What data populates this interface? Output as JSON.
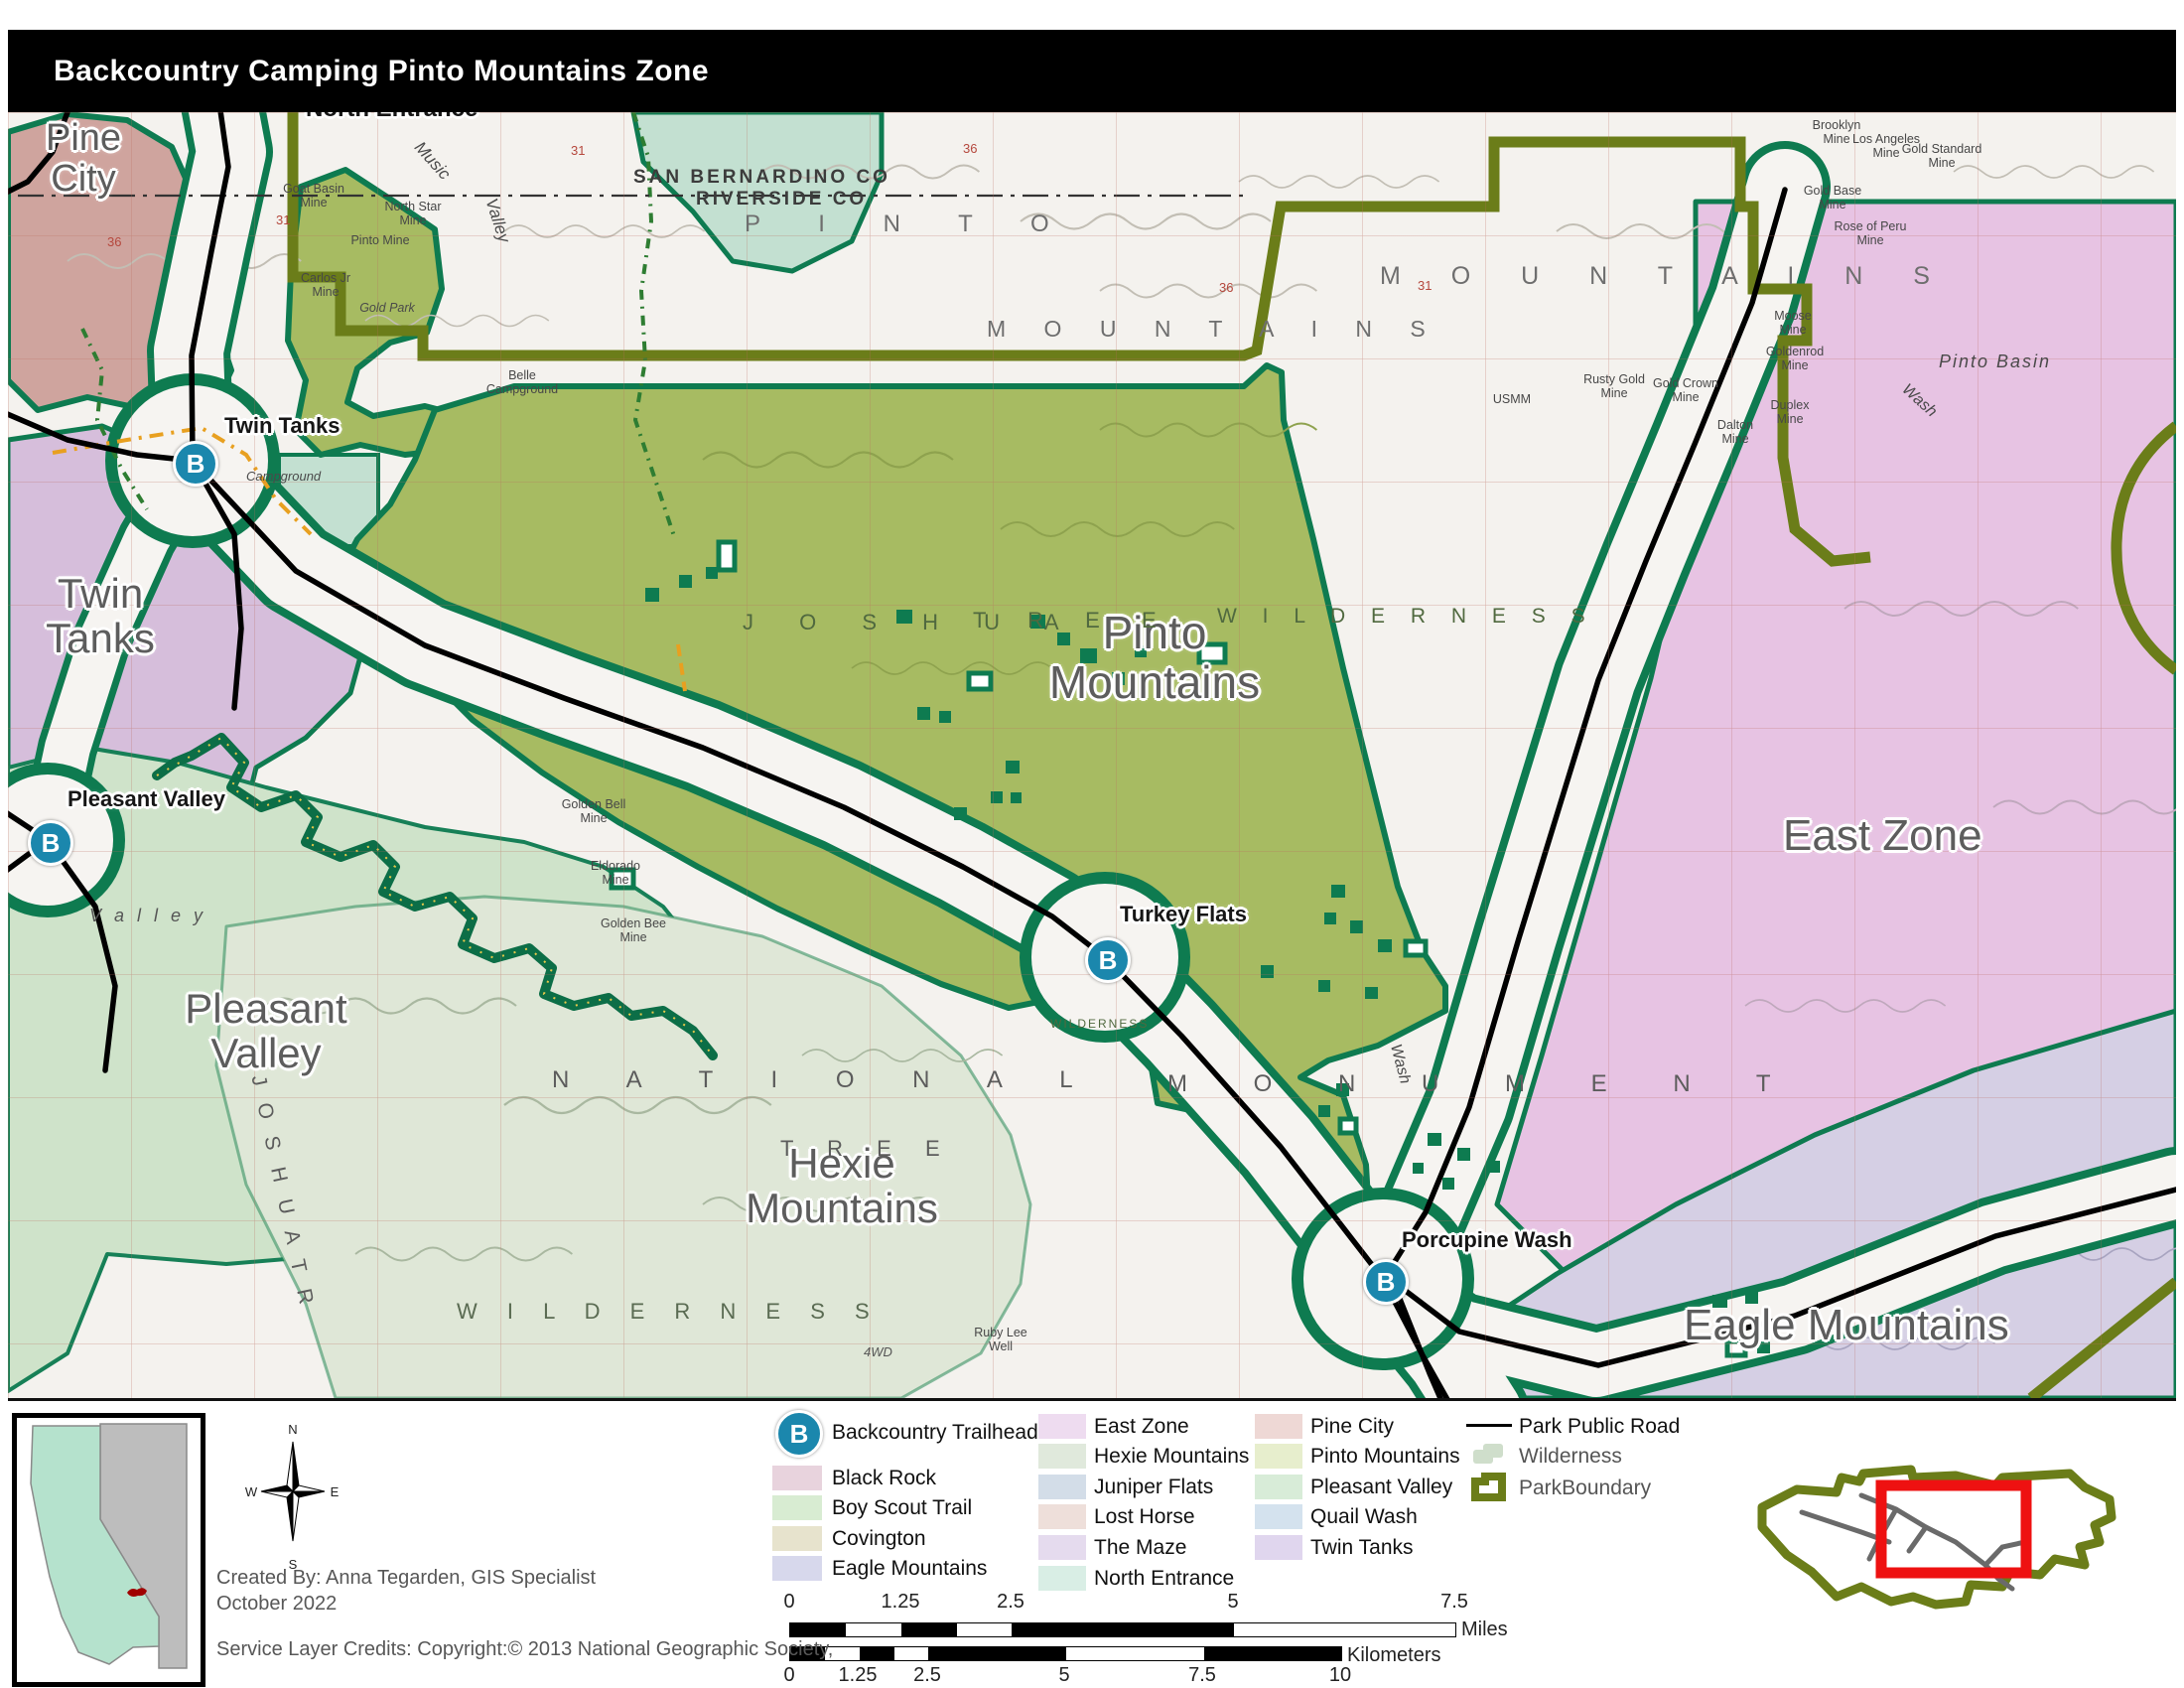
{
  "title": "Backcountry Camping Pinto Mountains Zone",
  "map": {
    "zone_labels": {
      "pine_city": "Pine\nCity",
      "twin_tanks": "Twin\nTanks",
      "pleasant_valley": "Pleasant\nValley",
      "hexie": "Hexie\nMountains",
      "pinto": "Pinto\nMountains",
      "east_zone": "East Zone",
      "eagle": "Eagle Mountains"
    },
    "trailheads": {
      "symbol": "B",
      "north_entrance": "North Entrance",
      "twin_tanks": "Twin Tanks",
      "pleasant_valley": "Pleasant Valley",
      "turkey_flats": "Turkey Flats",
      "porcupine_wash": "Porcupine Wash"
    },
    "topo": {
      "county1": "SAN BERNARDINO  CO",
      "county2": "RIVERSIDE  CO",
      "pinto_sp": "P I N T O",
      "mountains_sp": "M O U N T A I N S",
      "mountains_sp2": "M O U N T A I N S",
      "joshua_sp": "J O S H U A",
      "tree_sp": "T R E E",
      "wilderness_sp": "W I L D E R N E S S",
      "national_sp": "N A T I O N A L",
      "monument_sp": "M O N U M E N T",
      "tree_sp2": "T R E E",
      "joshua_rot": "J O S H U A   T R",
      "wilderness_sp2": "W I L D E R N E S S",
      "wilderness_tiny": "WILDERNESS",
      "valley_pv": "V a l l e y",
      "music": "Music",
      "valley": "Valley",
      "pinto_basin": "Pinto    Basin",
      "wash": "Wash",
      "wash2": "Wash",
      "fourwd": "4WD",
      "usmm": "USMM",
      "campground": "Campground"
    },
    "mines": {
      "goat": "Goat Basin\nMine",
      "north_star": "North Star\nMine",
      "pinto_mine": "Pinto Mine",
      "carlos": "Carlos Jr\nMine",
      "gold_park": "Gold Park",
      "belle": "Belle\nCampground",
      "brooklyn": "Brooklyn\nMine",
      "los_angeles": "Los Angeles\nMine",
      "gold_standard": "Gold Standard\nMine",
      "gold_base": "Gold Base\nMine",
      "rose_peru": "Rose of Peru\nMine",
      "moose": "Moose\nMine",
      "goldenrod": "Goldenrod\nMine",
      "duplex": "Duplex\nMine",
      "rusty_gold": "Rusty Gold\nMine",
      "gold_crown": "Gold Crown\nMine",
      "dalton": "Dalton\nMine",
      "golden_bell": "Golden Bell\nMine",
      "eldorado": "Eldorado\nMine",
      "golden_bee": "Golden Bee\nMine",
      "ruby_lee": "Ruby Lee\nWell"
    },
    "sections": {
      "a": "36",
      "b": "31",
      "c": "36",
      "d": "36",
      "e": "31",
      "f": "31"
    }
  },
  "legend": {
    "trailhead": {
      "symbol": "B",
      "label": "Backcountry Trailhead"
    },
    "zones": [
      {
        "label": "Black Rock",
        "color": "#e8d3dd"
      },
      {
        "label": "Boy Scout Trail",
        "color": "#d8ecd2"
      },
      {
        "label": "Covington",
        "color": "#e7e3cd"
      },
      {
        "label": "Eagle Mountains",
        "color": "#d7d8ec"
      },
      {
        "label": "East Zone",
        "color": "#eedcf0"
      },
      {
        "label": "Hexie Mountains",
        "color": "#e0e9dc"
      },
      {
        "label": "Juniper Flats",
        "color": "#d3dde8"
      },
      {
        "label": "Lost Horse",
        "color": "#eedfda"
      },
      {
        "label": "The Maze",
        "color": "#e5dbee"
      },
      {
        "label": "North Entrance",
        "color": "#d9eee5"
      },
      {
        "label": "Pine City",
        "color": "#eed8d5"
      },
      {
        "label": "Pinto Mountains",
        "color": "#e7eecd"
      },
      {
        "label": "Pleasant Valley",
        "color": "#d8ecd8"
      },
      {
        "label": "Quail Wash",
        "color": "#d4e2ee"
      },
      {
        "label": "Twin Tanks",
        "color": "#e0d6ee"
      }
    ],
    "road": {
      "label": "Park Public Road"
    },
    "wilderness": {
      "label": "Wilderness"
    },
    "boundary": {
      "label": "ParkBoundary"
    }
  },
  "credits": {
    "line1": "Created By: Anna Tegarden, GIS Specialist",
    "line2": "October 2022",
    "line3": "Service Layer Credits: Copyright:© 2013 National Geographic Society,"
  },
  "compass": {
    "n": "N",
    "s": "S",
    "e": "E",
    "w": "W"
  },
  "scale": {
    "miles": {
      "ticks": [
        "0",
        "1.25",
        "2.5",
        "5",
        "7.5"
      ],
      "unit": "Miles"
    },
    "km": {
      "ticks": [
        "0",
        "1.25",
        "2.5",
        "5",
        "7.5",
        "10"
      ],
      "unit": "Kilometers"
    }
  },
  "colors": {
    "pinto_zone": "#a7bb62",
    "east_zone": "#e7c3e3",
    "eagle_zone": "#d5cfe4",
    "twin_tanks_zone": "#d6bedb",
    "pleasant_valley_zone": "#cfe3ca",
    "hexie_zone": "#dfe7d7",
    "pine_city_zone": "#cfa49e",
    "north_entrance_zone": "#c3e0d1",
    "park_boundary": "#6b7d19",
    "wilderness_line": "#0e7b50",
    "trailhead_marker": "#1b87ad",
    "road": "#000000",
    "extent_rect": "#ee1111"
  }
}
